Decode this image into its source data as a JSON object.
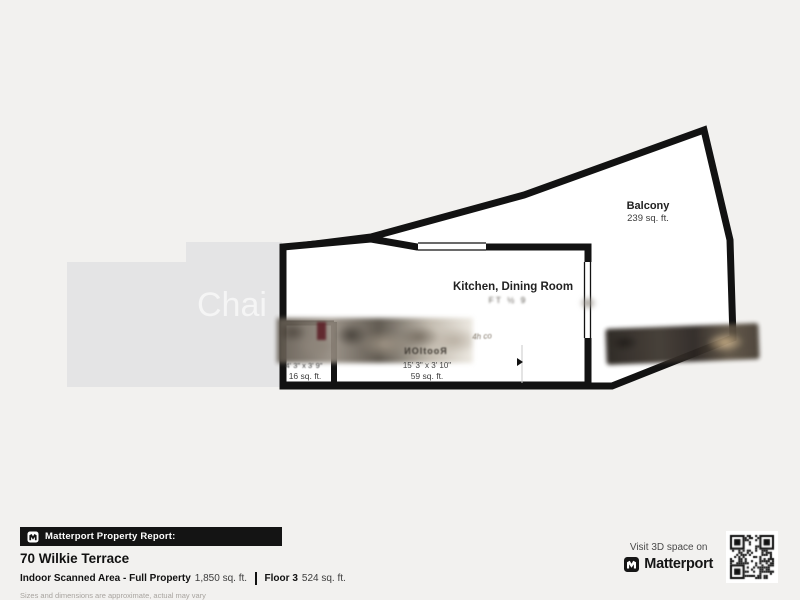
{
  "plan": {
    "watermark": "Chai",
    "rooms": {
      "balcony": {
        "name": "Balcony",
        "area": "239 sq. ft."
      },
      "kitchen": {
        "name": "Kitchen, Dining Room",
        "area_blurred": "FT ½ 9"
      },
      "storage": {
        "dims": "4' 3\" x 3' 9\"",
        "area": "16 sq. ft."
      },
      "hallway": {
        "name_blurred": "ИOItooЯ",
        "dims": "15' 3\" x 3' 10\"",
        "area": "59 sq. ft."
      }
    },
    "photo_scribble": "4h co"
  },
  "footer": {
    "report_badge": "Matterport Property Report:",
    "address": "70 Wilkie Terrace",
    "scanned_label": "Indoor Scanned Area - Full Property",
    "scanned_value": "1,850 sq. ft.",
    "floor_label": "Floor 3",
    "floor_value": "524 sq. ft.",
    "disclaimer": "Sizes and dimensions are approximate, actual may vary"
  },
  "cta": {
    "visit_text": "Visit 3D space on",
    "brand": "Matterport"
  },
  "colors": {
    "background": "#f2f1ef",
    "walls": "#121212",
    "neighbor_area": "#e4e4e5",
    "footer_bar": "#141414"
  }
}
